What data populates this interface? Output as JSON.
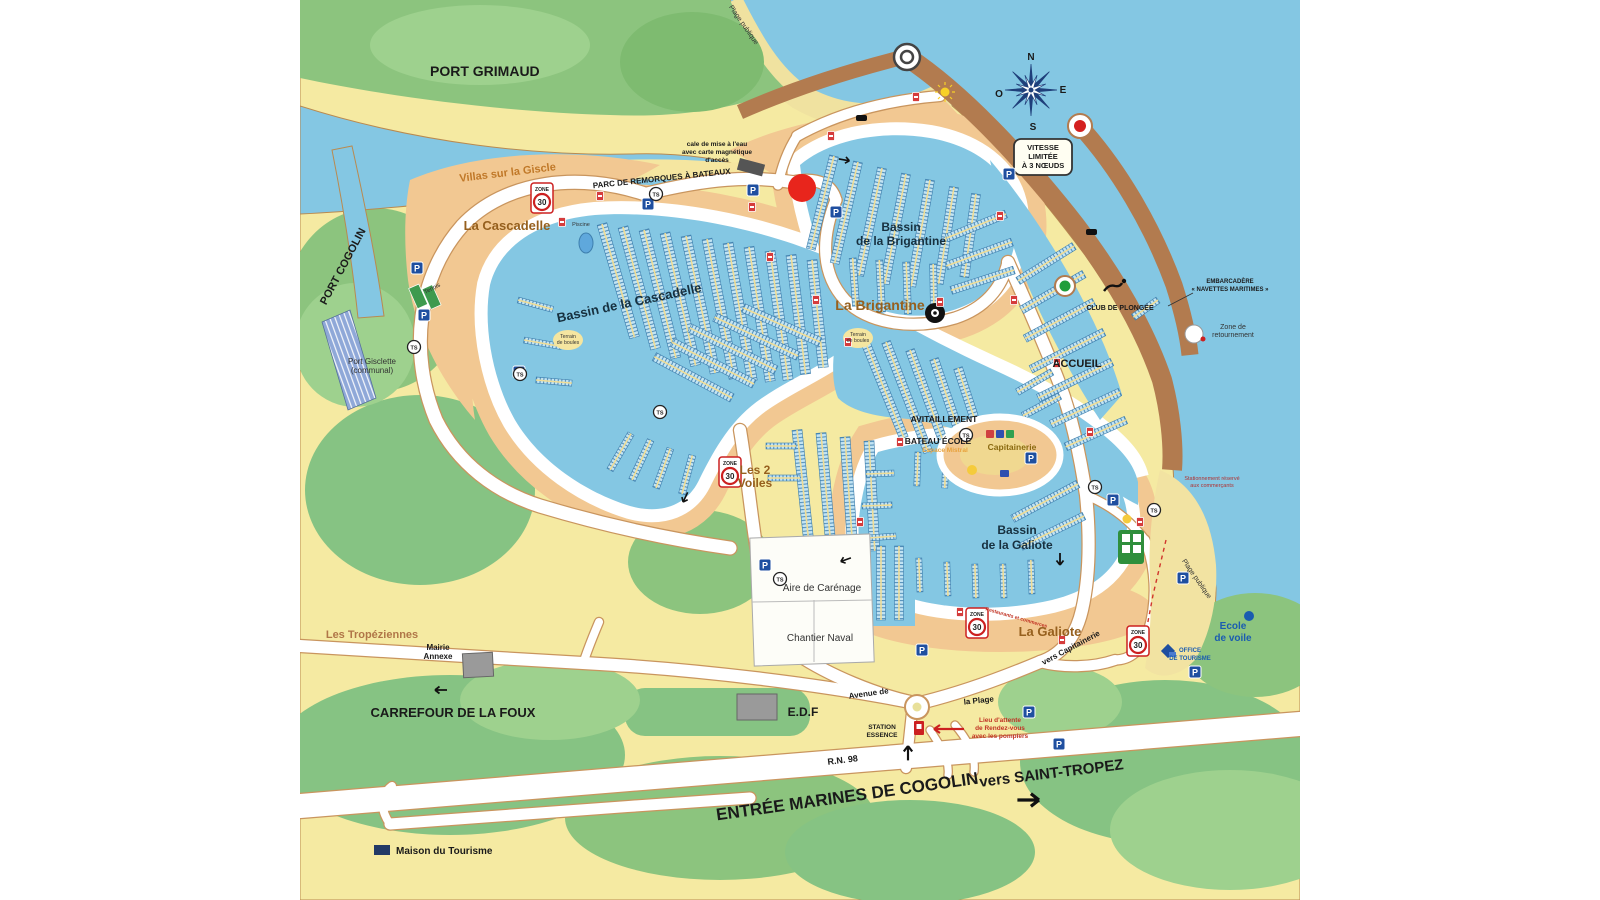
{
  "title": "Plan du port - Marines de Cogolin",
  "marker": {
    "color": "#e8251c"
  },
  "colors": {
    "sea": "#84c7e3",
    "land_yellow": "#f5eaa2",
    "green": "#86c383",
    "green_light": "#a8d69a",
    "sand_orange": "#f2c892",
    "jetty_brown": "#b27b4f",
    "road_white": "#ffffff",
    "slip_blue": "#3e7fae",
    "sign_blue": "#1f4fa0",
    "sign_red": "#cc2020",
    "beacon_green": "#1f9d3a"
  },
  "labels": {
    "port_grimaud": "PORT GRIMAUD",
    "plage_publique_top": "Plage publique",
    "villas_giscle": "Villas sur la Giscle",
    "parc_remorques": "PARC DE REMORQUES À BATEAUX",
    "cale_1": "cale de mise à l'eau",
    "cale_2": "avec carte magnétique",
    "cale_3": "d'accès",
    "la_cascadelle": "La Cascadelle",
    "piscine": "Piscine",
    "port_cogolin": "PORT COGOLIN",
    "tennis": "Tennis",
    "port_gisclette_1": "Port Gisclette",
    "port_gisclette_2": "(communal)",
    "bassin_cascadelle": "Bassin de la Cascadelle",
    "terrain_boules_1a": "Terrain",
    "terrain_boules_1b": "de boules",
    "terrain_boules_2a": "Terrain",
    "terrain_boules_2b": "de boules",
    "bassin_brigantine_1": "Bassin",
    "bassin_brigantine_2": "de la Brigantine",
    "la_brigantine": "La Brigantine",
    "vitesse_1": "VITESSE",
    "vitesse_2": "LIMITÉE",
    "vitesse_3": "À 3 NŒUDS",
    "club_plongee": "CLUB DE PLONGÉE",
    "embarcadere_1": "EMBARCADÈRE",
    "embarcadere_2": "« NAVETTES MARITIMES »",
    "zone_retournement_1": "Zone de",
    "zone_retournement_2": "retournement",
    "accueil": "ACCUEIL",
    "avitaillement": "AVITAILLEMENT",
    "bateau_ecole": "BATEAU ÉCOLE",
    "espace_mistral": "Espace Mistral",
    "capitainerie": "Capitainerie",
    "les_2_voiles_1": "Les 2",
    "les_2_voiles_2": "Voiles",
    "bassin_galiote_1": "Bassin",
    "bassin_galiote_2": "de la Galiote",
    "aire_carenage": "Aire de Carénage",
    "chantier_naval": "Chantier Naval",
    "la_galiote": "La Galiote",
    "vers_capitainerie": "vers Capitainerie",
    "restaurants_commerces": "Restaurants et commerces",
    "reserve_commercants_1": "Stationnement réservé",
    "reserve_commercants_2": "aux commerçants",
    "office_tourisme_1": "OFFICE",
    "office_tourisme_2": "DE TOURISME",
    "edf": "E.D.F",
    "station_essence_1": "STATION",
    "station_essence_2": "ESSENCE",
    "lieu_attente_1": "Lieu d'attente",
    "lieu_attente_2": "de Rendez-vous",
    "lieu_attente_3": "avec les pompiers",
    "avenue_de": "Avenue de",
    "la_plage": "la Plage",
    "rn98": "R.N. 98",
    "entree_marines": "ENTRÉE MARINES DE COGOLIN",
    "vers_st_tropez": "vers SAINT-TROPEZ",
    "carrefour_foux": "CARREFOUR DE LA FOUX",
    "mairie_annexe_1": "Mairie",
    "mairie_annexe_2": "Annexe",
    "les_tropeziennes": "Les Tropéziennes",
    "maison_tourisme": "Maison du Tourisme",
    "ecole_voile_1": "Ecole",
    "ecole_voile_2": "de voile",
    "plage_publique_right": "Plage publique",
    "zone": "ZONE",
    "speed_30": "30",
    "p": "P",
    "ts": "TS"
  },
  "compass": {
    "n": "N",
    "e": "E",
    "s": "S",
    "o": "O"
  }
}
